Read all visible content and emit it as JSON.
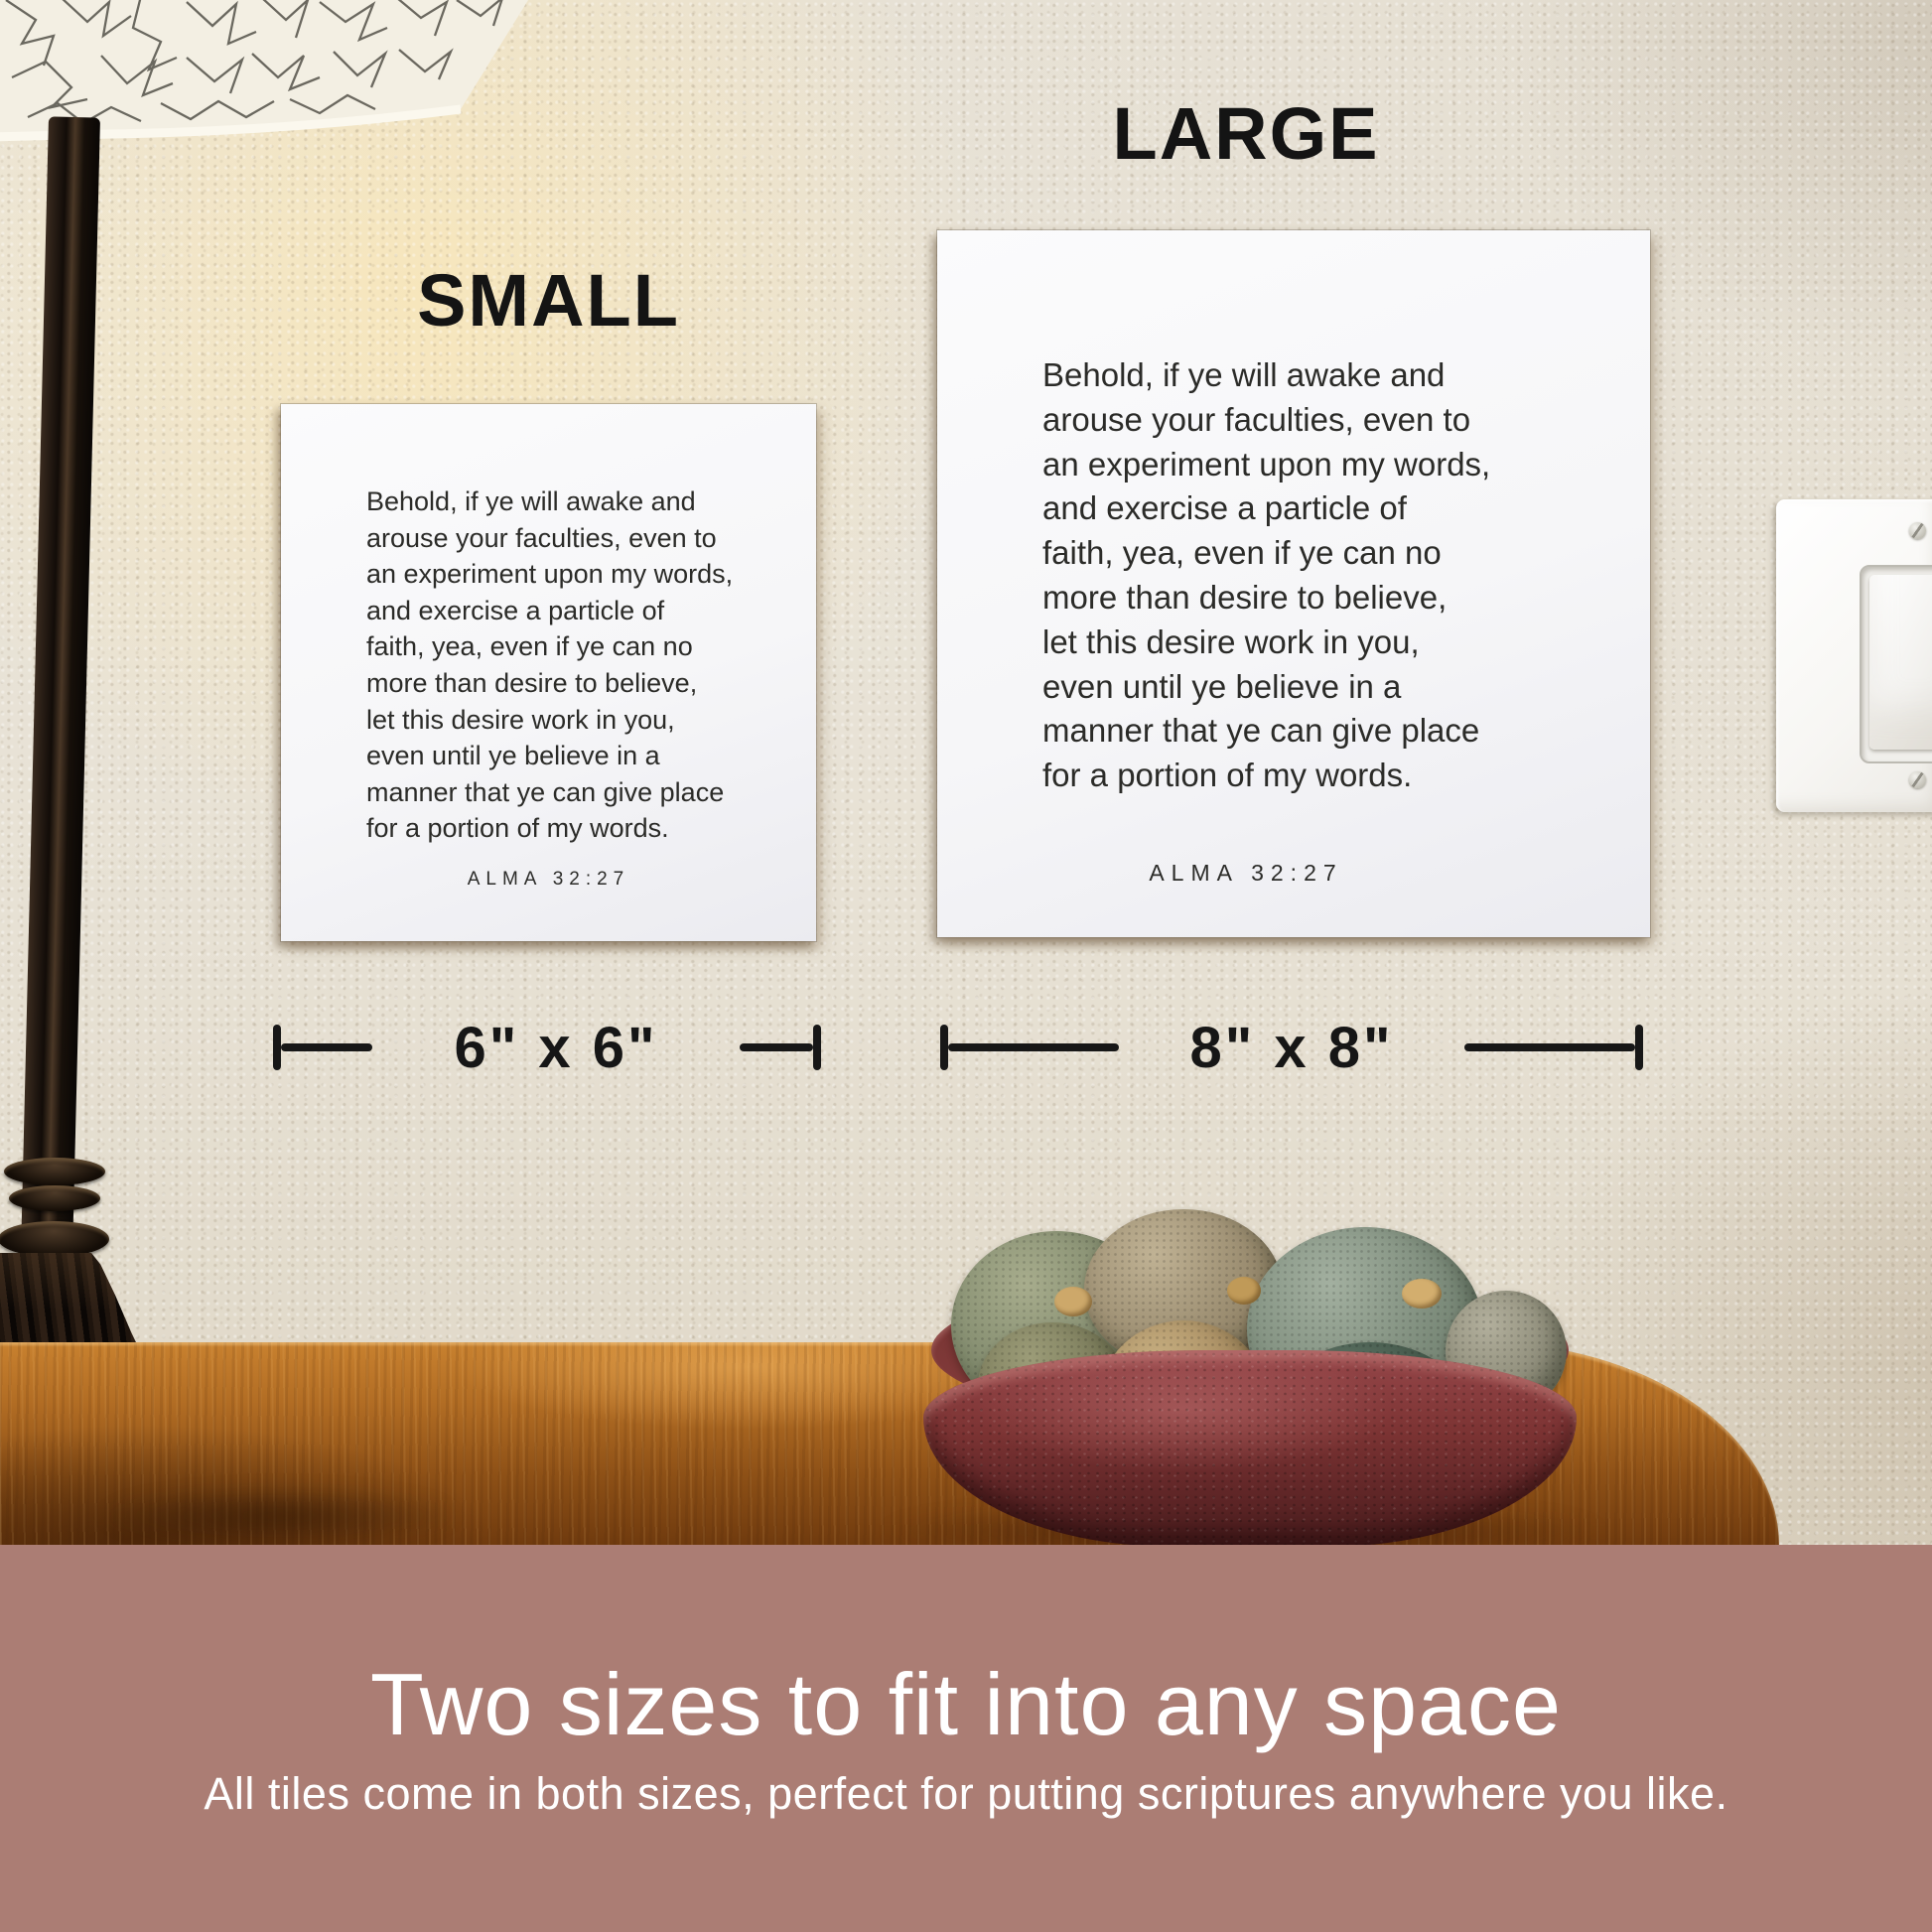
{
  "size_labels": {
    "small": "SMALL",
    "large": "LARGE"
  },
  "tiles": {
    "scripture_lines": [
      "Behold, if ye will awake and",
      "arouse your faculties, even to",
      "an experiment upon my words,",
      "and exercise a particle of",
      "faith, yea, even if ye can no",
      "more than desire to believe,",
      "let this desire work in you,",
      "even until ye believe in a",
      "manner that ye can give place",
      "for a portion of my words."
    ],
    "reference": "ALMA 32:27"
  },
  "dimensions": {
    "small": "6\" x 6\"",
    "large": "8\" x 8\""
  },
  "banner": {
    "heading": "Two sizes to fit into any space",
    "subheading": "All tiles come in both sizes, perfect for putting scriptures anywhere you like."
  },
  "colors": {
    "banner-bg": "#ab7d74",
    "banner-text": "#ffffff",
    "wall": "#e9e4d8",
    "tile-bg": "#f6f6f8",
    "tile-text": "#2b2b28",
    "annotation": "#161616",
    "wood": "#a9661f",
    "bowl": "#7d3434"
  }
}
